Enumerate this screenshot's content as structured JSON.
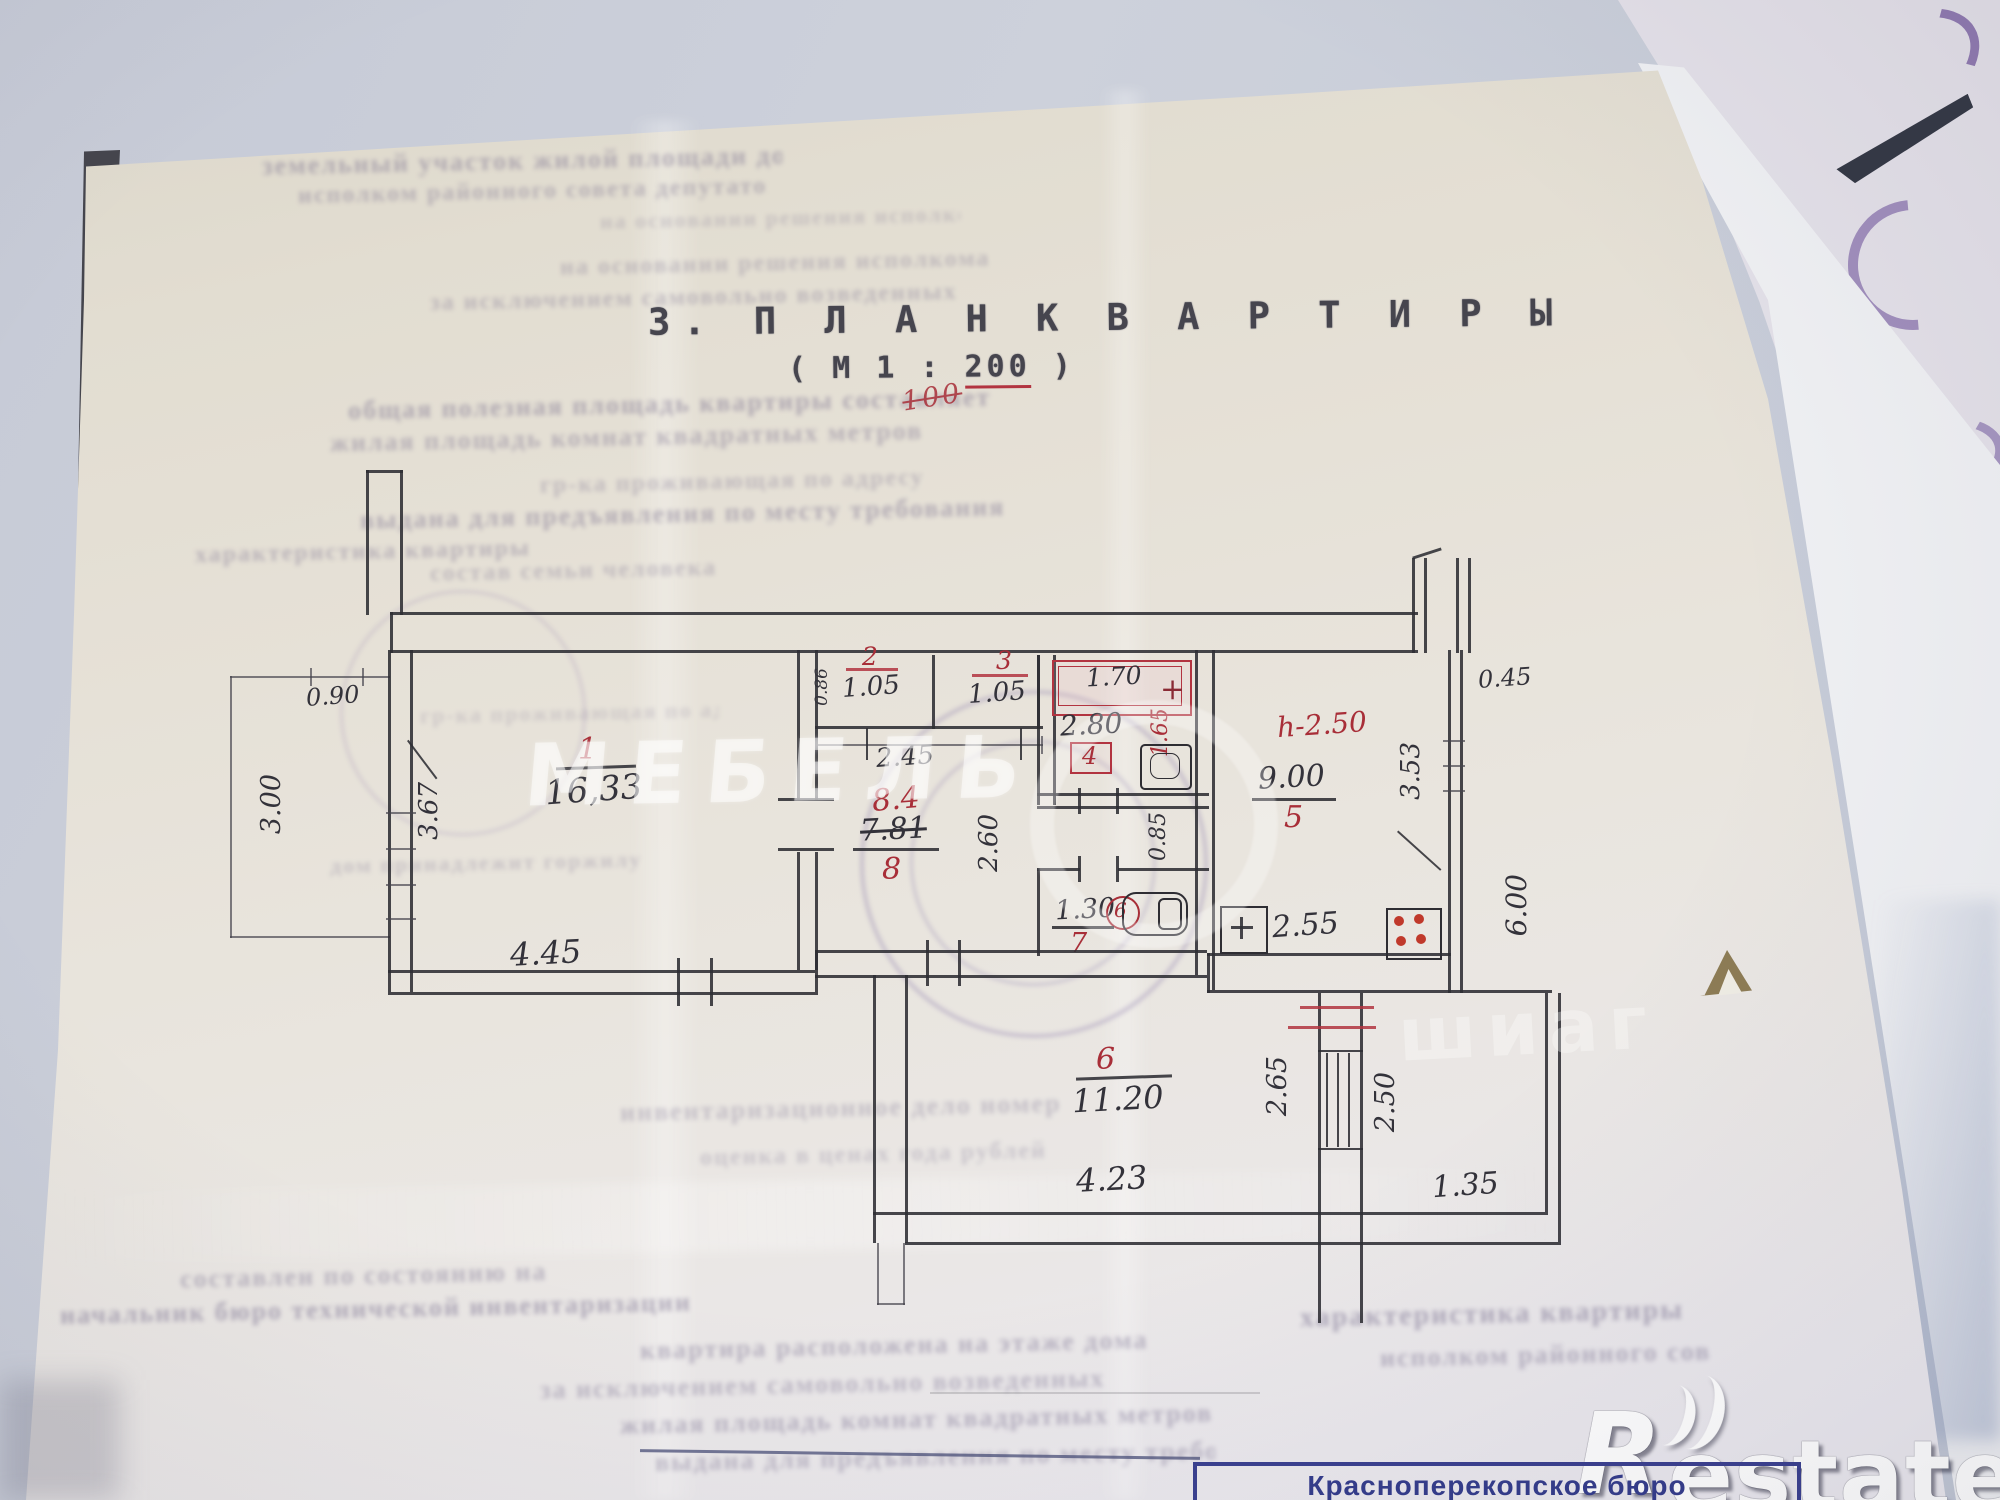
{
  "title": {
    "heading": "3. П Л А Н   К В А Р Т И Р Ы",
    "scale_prefix": "( М 1 : ",
    "scale_value": "200",
    "scale_suffix": " )",
    "scale_correction": "100"
  },
  "rooms": {
    "r1": {
      "num": "1",
      "area": "16,33"
    },
    "r2": {
      "num": "2",
      "area": "1.05"
    },
    "r3": {
      "num": "3",
      "area": "1.05"
    },
    "r4": {
      "num": "4",
      "area": "2.80",
      "tub": "1.70",
      "plus": "+"
    },
    "r5": {
      "num": "5",
      "area": "9.00",
      "height_note": "h-2.50"
    },
    "r6": {
      "num": "6",
      "area": "11.20"
    },
    "r7": {
      "num": "7",
      "area": "1.30",
      "fixture_mark": "6"
    },
    "r8": {
      "num": "8",
      "area_new": "8.4",
      "area_old": "7.81"
    }
  },
  "dims": {
    "balcony_height": "3.00",
    "balcony_opening": "0.90",
    "room1_side": "3.67",
    "room1_width": "4.45",
    "closets_width": "2.45",
    "closet_depth": "0.86",
    "bath_width": "1.65",
    "hall_depth": "2.60",
    "passage_width": "0.85",
    "kitchen_width": "2.55",
    "kitchen_side": "3.53",
    "entry_depth": "0.45",
    "right_side": "6.00",
    "room6_width": "4.23",
    "kitchen_balcony_depth": "2.65",
    "kitchen_balcony_width": "2.50",
    "lower_right_width": "1.35"
  },
  "stamp": {
    "line1": "Красноперекопское бюро",
    "line2": "технической инвентаризации"
  },
  "watermarks": {
    "center": "МЕБЕЛЬ",
    "side": "шиаг",
    "logo_r": "R",
    "logo_text": "estate"
  },
  "colors": {
    "red_ink": "#a82e38",
    "blue_stamp": "#343c8c",
    "plan_ink": "#2e2d33"
  },
  "bleed_rows": [
    "земельный участок жилой площади дома",
    "исполком районного совета депутатов",
    "на основании решения исполкома",
    "за исключением самовольно возведенных",
    "общая полезная площадь квартиры составляет",
    "жилая площадь комнат квадратных метров",
    "гр-ка проживающая по адресу",
    "выдана для предъявления по месту требования",
    "характеристика квартиры",
    "состав семьи человека",
    "дом принадлежит горжилуправлению",
    "инвентаризационное дело номер",
    "оценка в ценах года рублей",
    "составлен по состоянию на",
    "начальник бюро технической инвентаризации",
    "квартира расположена на этаже дома"
  ]
}
